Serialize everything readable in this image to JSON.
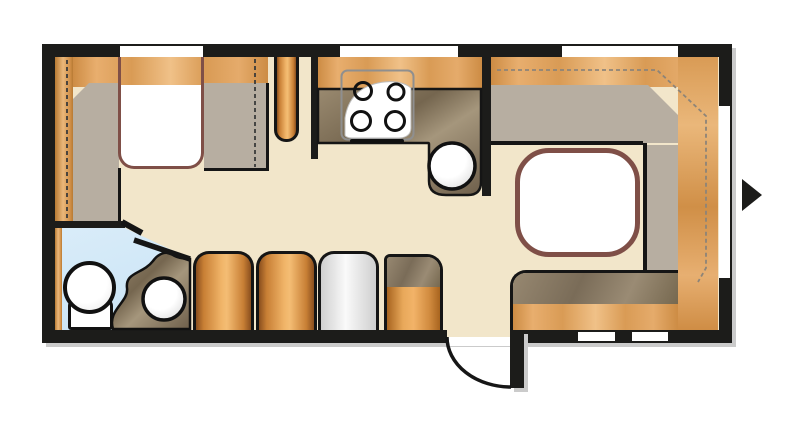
{
  "palette": {
    "wall": "#1c1c1a",
    "floor": "#f2e6ca",
    "wood-light": "#eeb878",
    "wood-mid": "#d69a54",
    "wood-deep": "#a96a28",
    "counter-light": "#a5967c",
    "counter-dark": "#6e5f4b",
    "cushion": "#b7aea1",
    "cushion-dark": "#8d7f6c",
    "bath-floor": "#cfe7f7",
    "accent-outline": "#7f4f47",
    "window": "#ffffff",
    "shadow": "#cbcbcb"
  },
  "inventory": {
    "rooms": [
      "bedroom",
      "kitchen",
      "dinette",
      "bathroom",
      "entrance"
    ],
    "furniture": [
      "double-bed",
      "bed-platform",
      "wardrobe-cylinder",
      "stove-four-burners",
      "kitchen-sink",
      "kitchen-counter",
      "dinette-table",
      "u-shaped-seating",
      "bench-seat",
      "toilet",
      "washbasin",
      "vanity-counter",
      "storage-cabinets"
    ],
    "openings": {
      "top_windows": 3,
      "right_window": 1,
      "rear_vents": 2,
      "entry_door": 1,
      "bathroom_door": 1
    },
    "markers": [
      "entry-direction-arrow-right"
    ]
  }
}
